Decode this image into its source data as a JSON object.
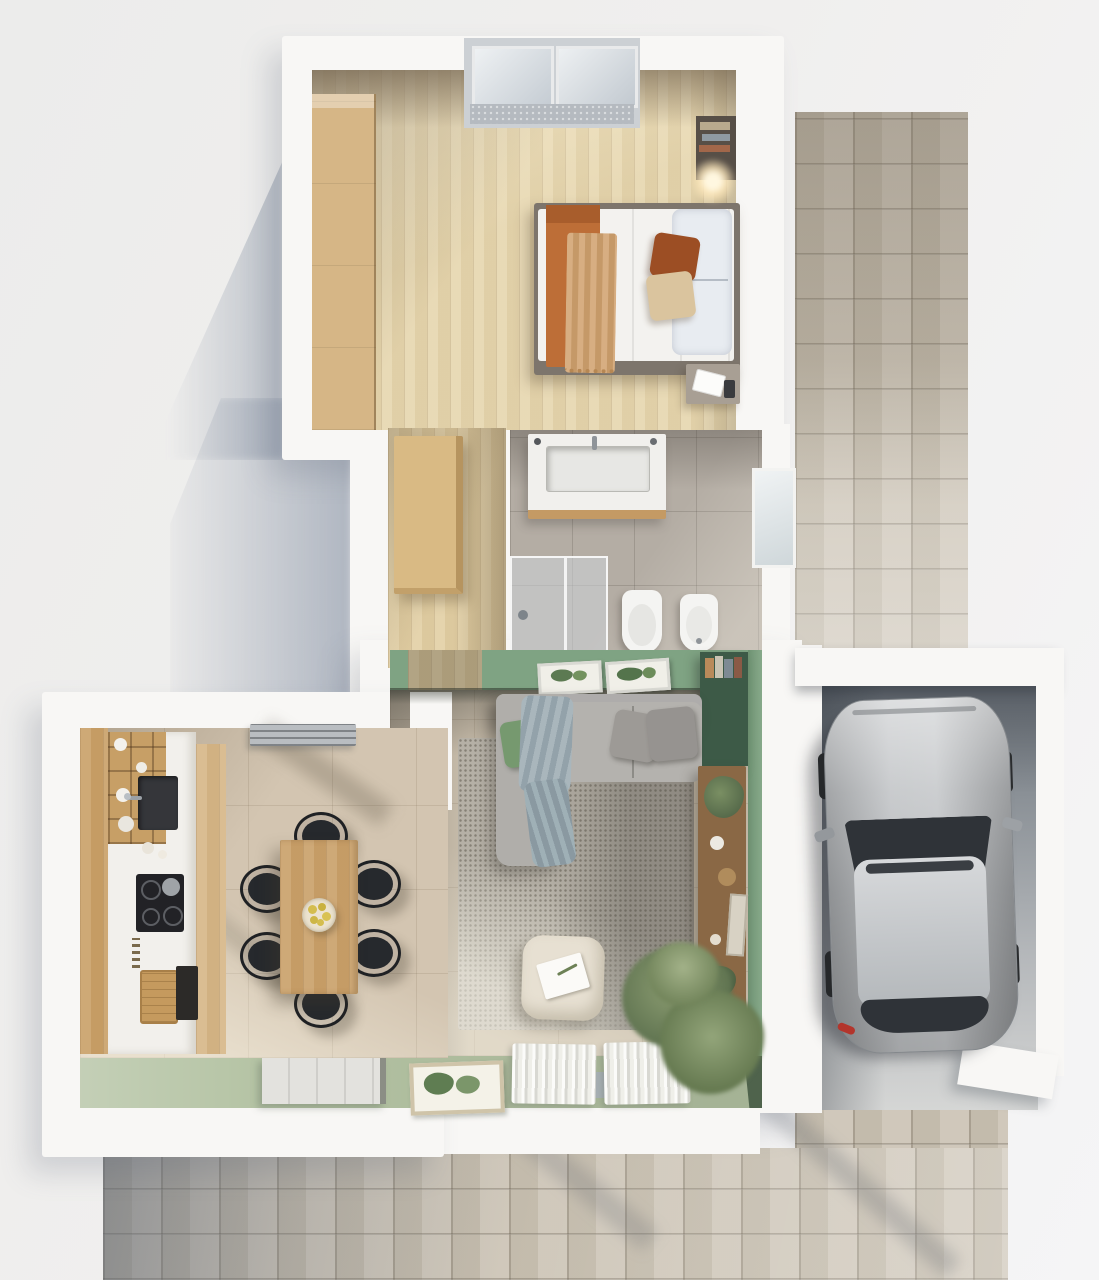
{
  "scene": {
    "kind": "3D top-down floor plan rendering",
    "view": "overhead axonometric",
    "canvas": {
      "width": 1099,
      "height": 1280
    },
    "has_text": false
  },
  "palette": {
    "background": "#f0efee",
    "wall_white": "#f8f7f5",
    "wood_floor": "#e6d6ae",
    "wood_hall": "#e2cfa4",
    "wood_cabinet": "#d6b686",
    "wood_mid": "#c99f67",
    "table_wood": "#c99f68",
    "green_wall": "#7fa383",
    "green_wall_strip": "#87a98a",
    "green_floor": "#b3c2a2",
    "green_dark": "#3d5a47",
    "tile_beige": "#d3c5b1",
    "tile_grey": "#b4ada4",
    "living_floor": "#c9beac",
    "rug": "#b5b0a6",
    "sofa": "#aeacab",
    "sofa_seat": "#b4b2ae",
    "mattress": "#f3f2ef",
    "blanket_orange": "#bd6e37",
    "throw_tan": "#d0a16e",
    "pillow_rust": "#9c4e24",
    "pillow_beige": "#dac49e",
    "pillow_grey": "#9d9a96",
    "pillow_green": "#76996f",
    "chair_black": "#26292d",
    "concrete": "#82888f",
    "paving": "#cbc3b4",
    "car_body": "#b7babd",
    "car_glass": "#2f3338",
    "curtain": "#f2f2ee",
    "plant_green": "#6d8156",
    "lemon_yellow": "#d4bd4e",
    "shadow_blue": "#8a96ac",
    "lamp_glow": "#ffe9bc"
  },
  "rooms": {
    "bedroom": {
      "name": "Bedroom",
      "items": [
        "double bed",
        "orange blanket",
        "tan throw",
        "pillows",
        "built-in wardrobe",
        "wall shelf with books",
        "bedside lamp",
        "nightstand with open book",
        "casement window"
      ]
    },
    "hallway": {
      "name": "Hallway",
      "items": [
        "tall wooden cabinet",
        "oak flooring"
      ]
    },
    "bathroom": {
      "name": "Bathroom",
      "items": [
        "vanity with sink",
        "walk-in glass shower",
        "toilet",
        "bidet",
        "window"
      ]
    },
    "living_room": {
      "name": "Living room",
      "items": [
        "corner sofa",
        "green cushion",
        "grey throw blanket",
        "textured area rug",
        "pouf with book",
        "large potted plant",
        "wooden sideboard with plants",
        "green bookcase",
        "two botanical prints",
        "window with sheer curtains",
        "framed wall art"
      ]
    },
    "kitchen_dining": {
      "name": "Kitchen and dining room",
      "items": [
        "kitchen run with wooden cabinets",
        "open shelves with dishes",
        "dark sink with faucet",
        "induction cooktop",
        "oven",
        "cutting board",
        "extractor hood",
        "wooden dining table",
        "six black chairs",
        "bowl of lemons",
        "entrance door",
        "botanical print"
      ]
    },
    "carport": {
      "name": "Carport / garage",
      "items": [
        "silver car",
        "concrete floor",
        "white perimeter walls"
      ]
    },
    "exterior": {
      "name": "Exterior",
      "items": [
        "stone paved driveway",
        "stone paved walkway",
        "soft cast shadows"
      ]
    }
  }
}
